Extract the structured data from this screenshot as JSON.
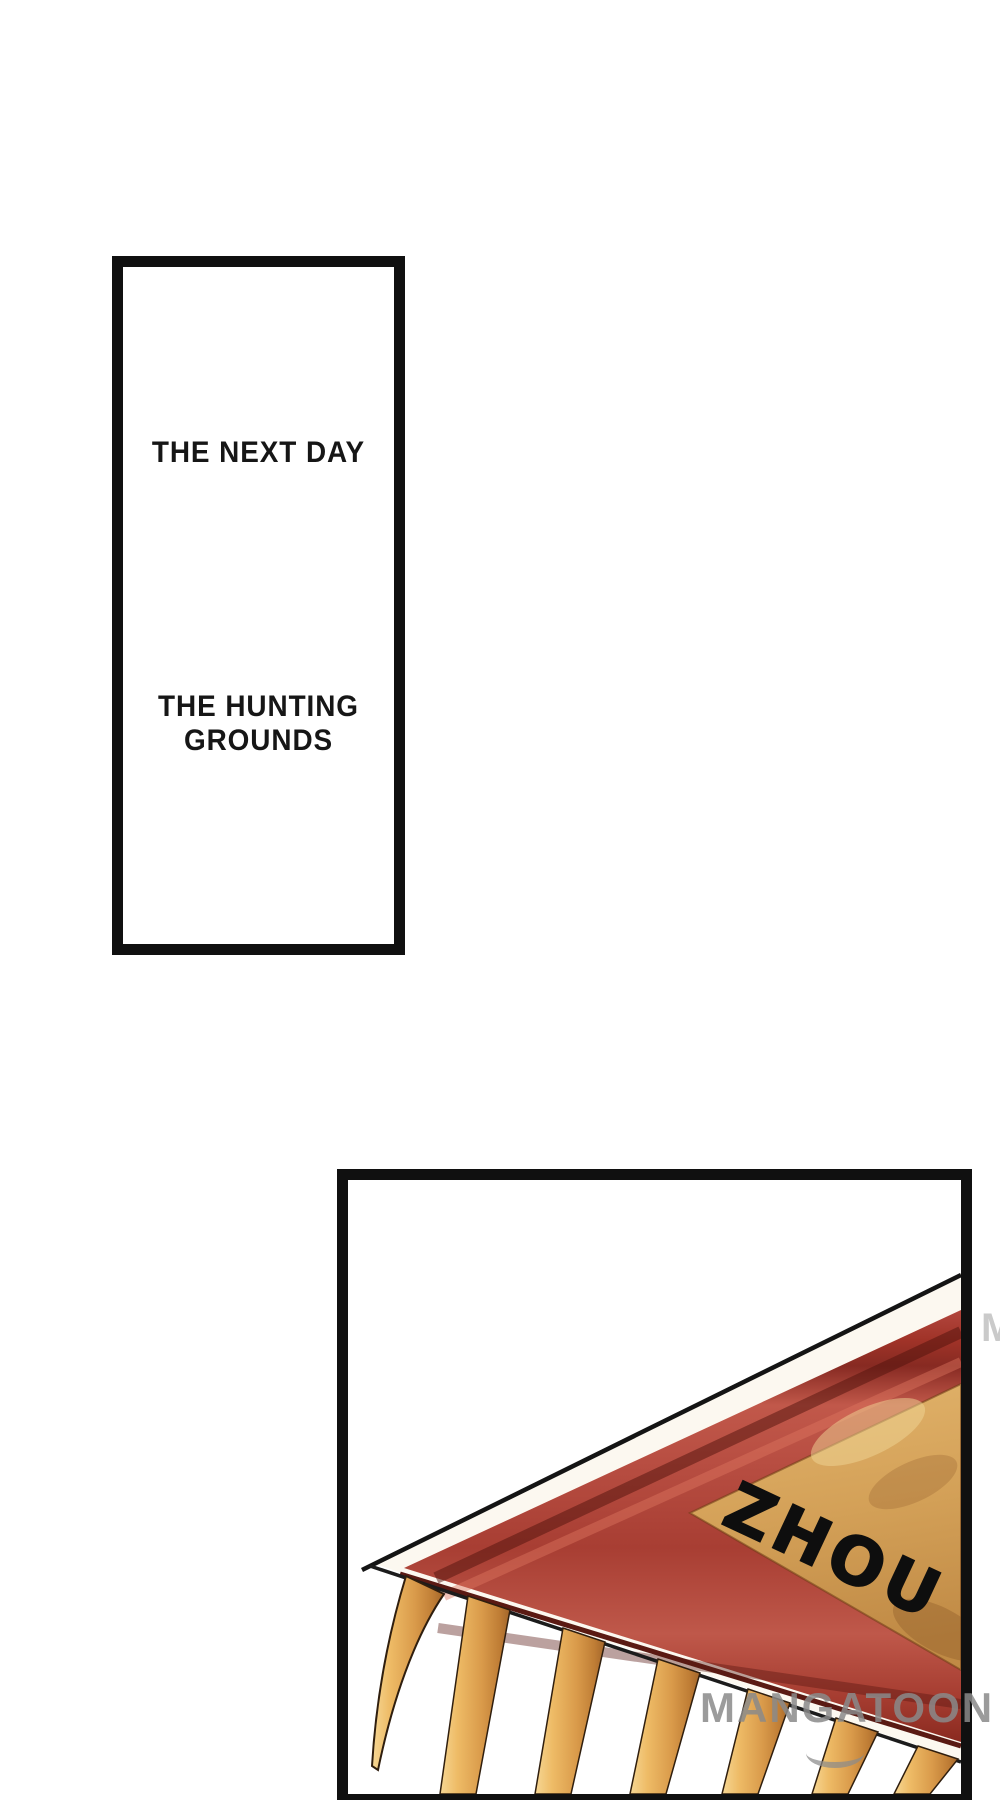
{
  "page": {
    "background": "#ffffff"
  },
  "panel1": {
    "caption_top": "THE NEXT DAY",
    "caption_bottom_lines": [
      "THE HUNTING",
      "GROUNDS"
    ],
    "border_color": "#101010",
    "text_color": "#161616"
  },
  "panel2": {
    "banner_text": "ZHOU",
    "border_color": "#101010",
    "colors": {
      "banner_red": "#b5453c",
      "banner_red_dark": "#8c2b23",
      "banner_red_light": "#c96353",
      "banner_maroon_edge": "#5a1a13",
      "banner_tan": "#d2a057",
      "banner_tan_light": "#e3bc7a",
      "fringe_gold": "#e0a455",
      "fringe_gold_light": "#f6d794",
      "fringe_gold_dark": "#a2652a",
      "edging_white": "#fcf8f0",
      "outline_black": "#141414"
    }
  },
  "watermark": {
    "text": "MANGATOON",
    "fragment": "M",
    "color": "#8a8a8a"
  }
}
